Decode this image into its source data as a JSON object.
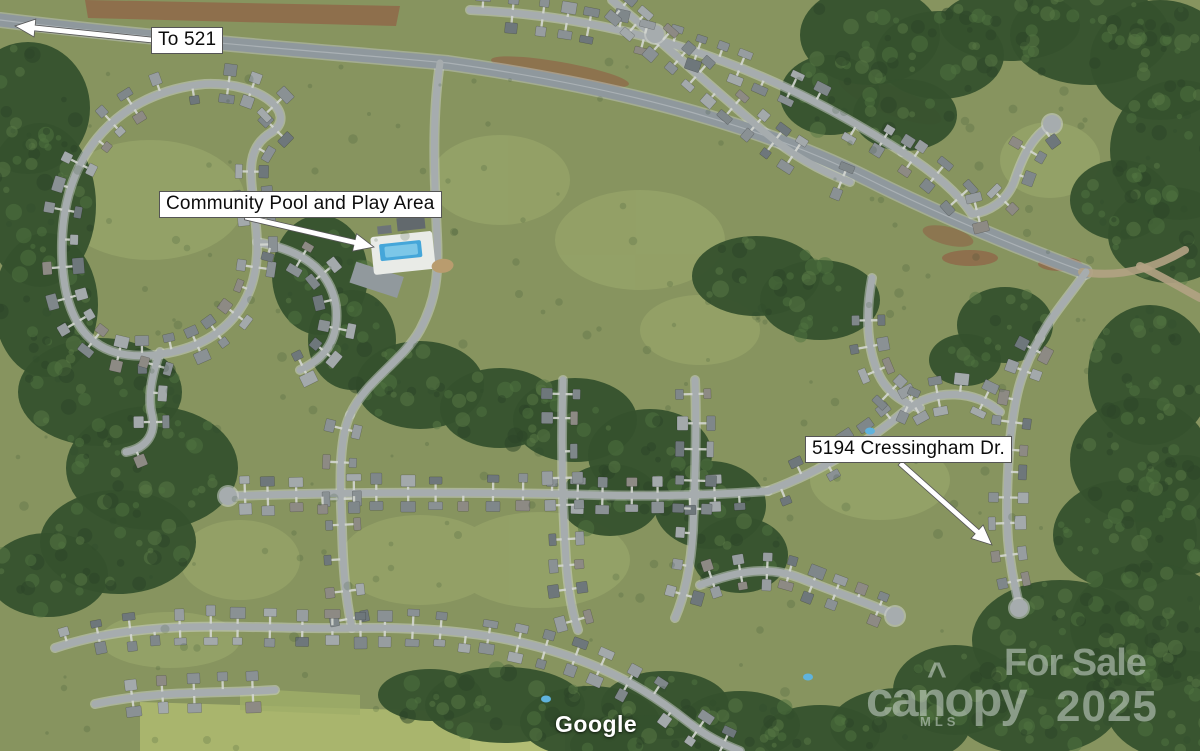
{
  "image_type": "aerial-listing-photo",
  "annotations": {
    "to_521": "To 521",
    "community_pool": "Community Pool and Play Area",
    "address": "5194 Cressingham Dr."
  },
  "watermarks": {
    "google": "Google",
    "for_sale": "For Sale",
    "brand": "canopy",
    "brand_caret": "^",
    "brand_sub": "MLS",
    "year": "2025"
  },
  "colors": {
    "grass": "#87945f",
    "grass_light": "#9dab6d",
    "field": "#a9b56d",
    "forest": "#35512d",
    "forest_dark": "#2b4327",
    "forest_light": "#4f7340",
    "road": "#a6acae",
    "highway": "#8f989d",
    "dirt": "#8f6a4a",
    "house_shades": [
      "#7f878a",
      "#8a9194",
      "#979da0",
      "#6e777b",
      "#a3a9ab",
      "#8d8a84"
    ],
    "driveway": "#d4d7d2",
    "pool_water": "#45a6d9",
    "pool_water_light": "#7cc7e8",
    "pool_deck": "#e9ebe7",
    "label_bg": "#ffffff",
    "label_text": "#0c0c0c",
    "arrow_fill": "#ffffff",
    "arrow_stroke": "#555555",
    "watermark": "rgba(228,234,233,0.48)"
  }
}
